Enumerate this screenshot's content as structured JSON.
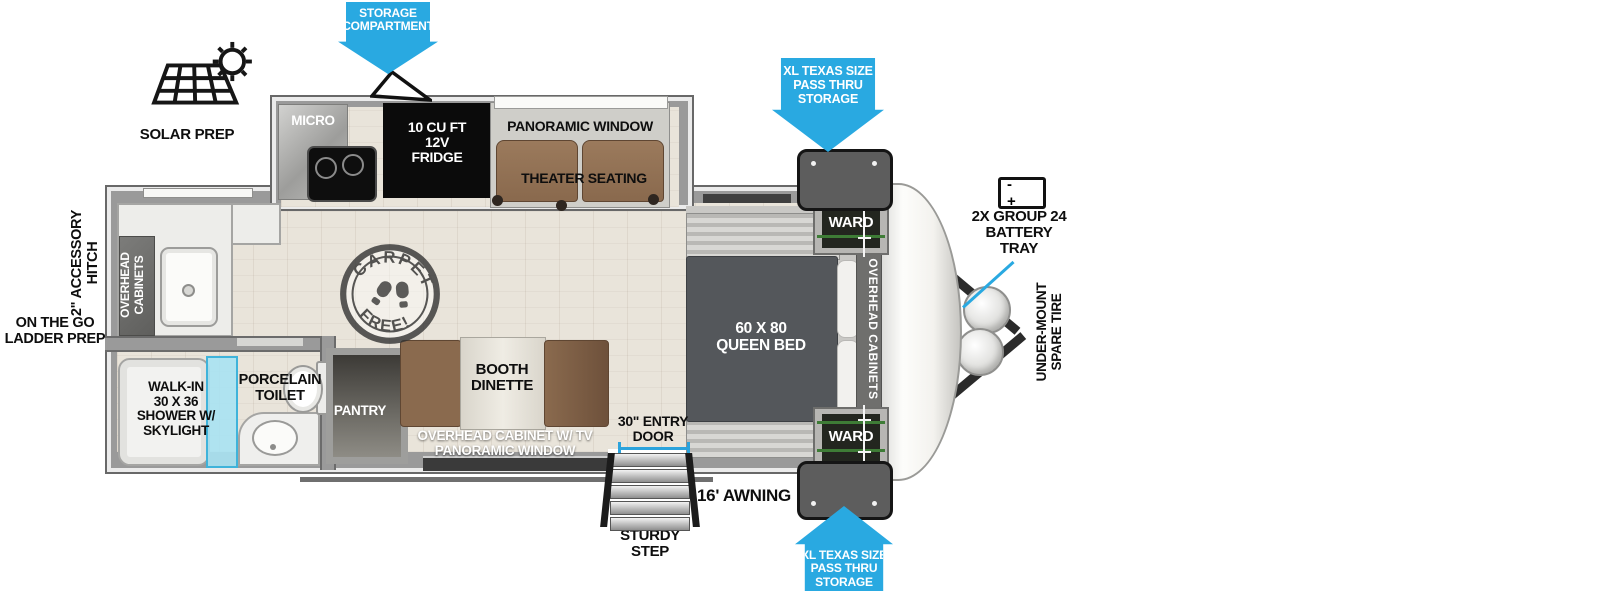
{
  "colors": {
    "arrow_blue": "#29A9E1",
    "wall_gray": "#9A9A9A",
    "floor_beige": "#E9E4DA",
    "bed_gray": "#54575B",
    "seating_brown": "#8A6A4E",
    "shower_glass_cyan": "#A9E2F2",
    "appliance_black": "#0B0B0B"
  },
  "exterior": {
    "storage_compartment": "STORAGE\nCOMPARTMENT",
    "solar_prep": "SOLAR PREP",
    "pass_thru_storage": "XL TEXAS SIZE\nPASS THRU\nSTORAGE",
    "battery_tray": "2X GROUP 24\nBATTERY\nTRAY",
    "battery_terminals": "-  +",
    "spare_tire": "UNDER-MOUNT\nSPARE TIRE",
    "accessory_hitch": "2\" ACCESSORY\nHITCH",
    "ladder_prep": "ON THE GO\nLADDER PREP",
    "awning": "16' AWNING",
    "sturdy_step": "STURDY\nSTEP",
    "entry_door": "30\" ENTRY\nDOOR"
  },
  "kitchen": {
    "micro": "MICRO",
    "fridge": "10 CU FT\n12V\nFRIDGE",
    "panoramic_window": "PANORAMIC WINDOW",
    "theater_seating": "THEATER SEATING",
    "pantry": "PANTRY",
    "booth_dinette": "BOOTH\nDINETTE",
    "overhead_cabinet_tv": "OVERHEAD CABINET W/ TV\nPANORAMIC WINDOW",
    "carpet_free_top": "CARPET",
    "carpet_free_bottom": "FREE!"
  },
  "bathroom": {
    "shower": "WALK-IN\n30 X 36\nSHOWER W/\nSKYLIGHT",
    "toilet": "PORCELAIN\nTOILET"
  },
  "bedroom": {
    "queen_bed": "60 X 80\nQUEEN BED",
    "ward": "WARD",
    "overhead_cabinets": "OVERHEAD CABINETS"
  },
  "rear_kitchen": {
    "overhead_cabinets": "OVERHEAD\nCABINETS"
  }
}
